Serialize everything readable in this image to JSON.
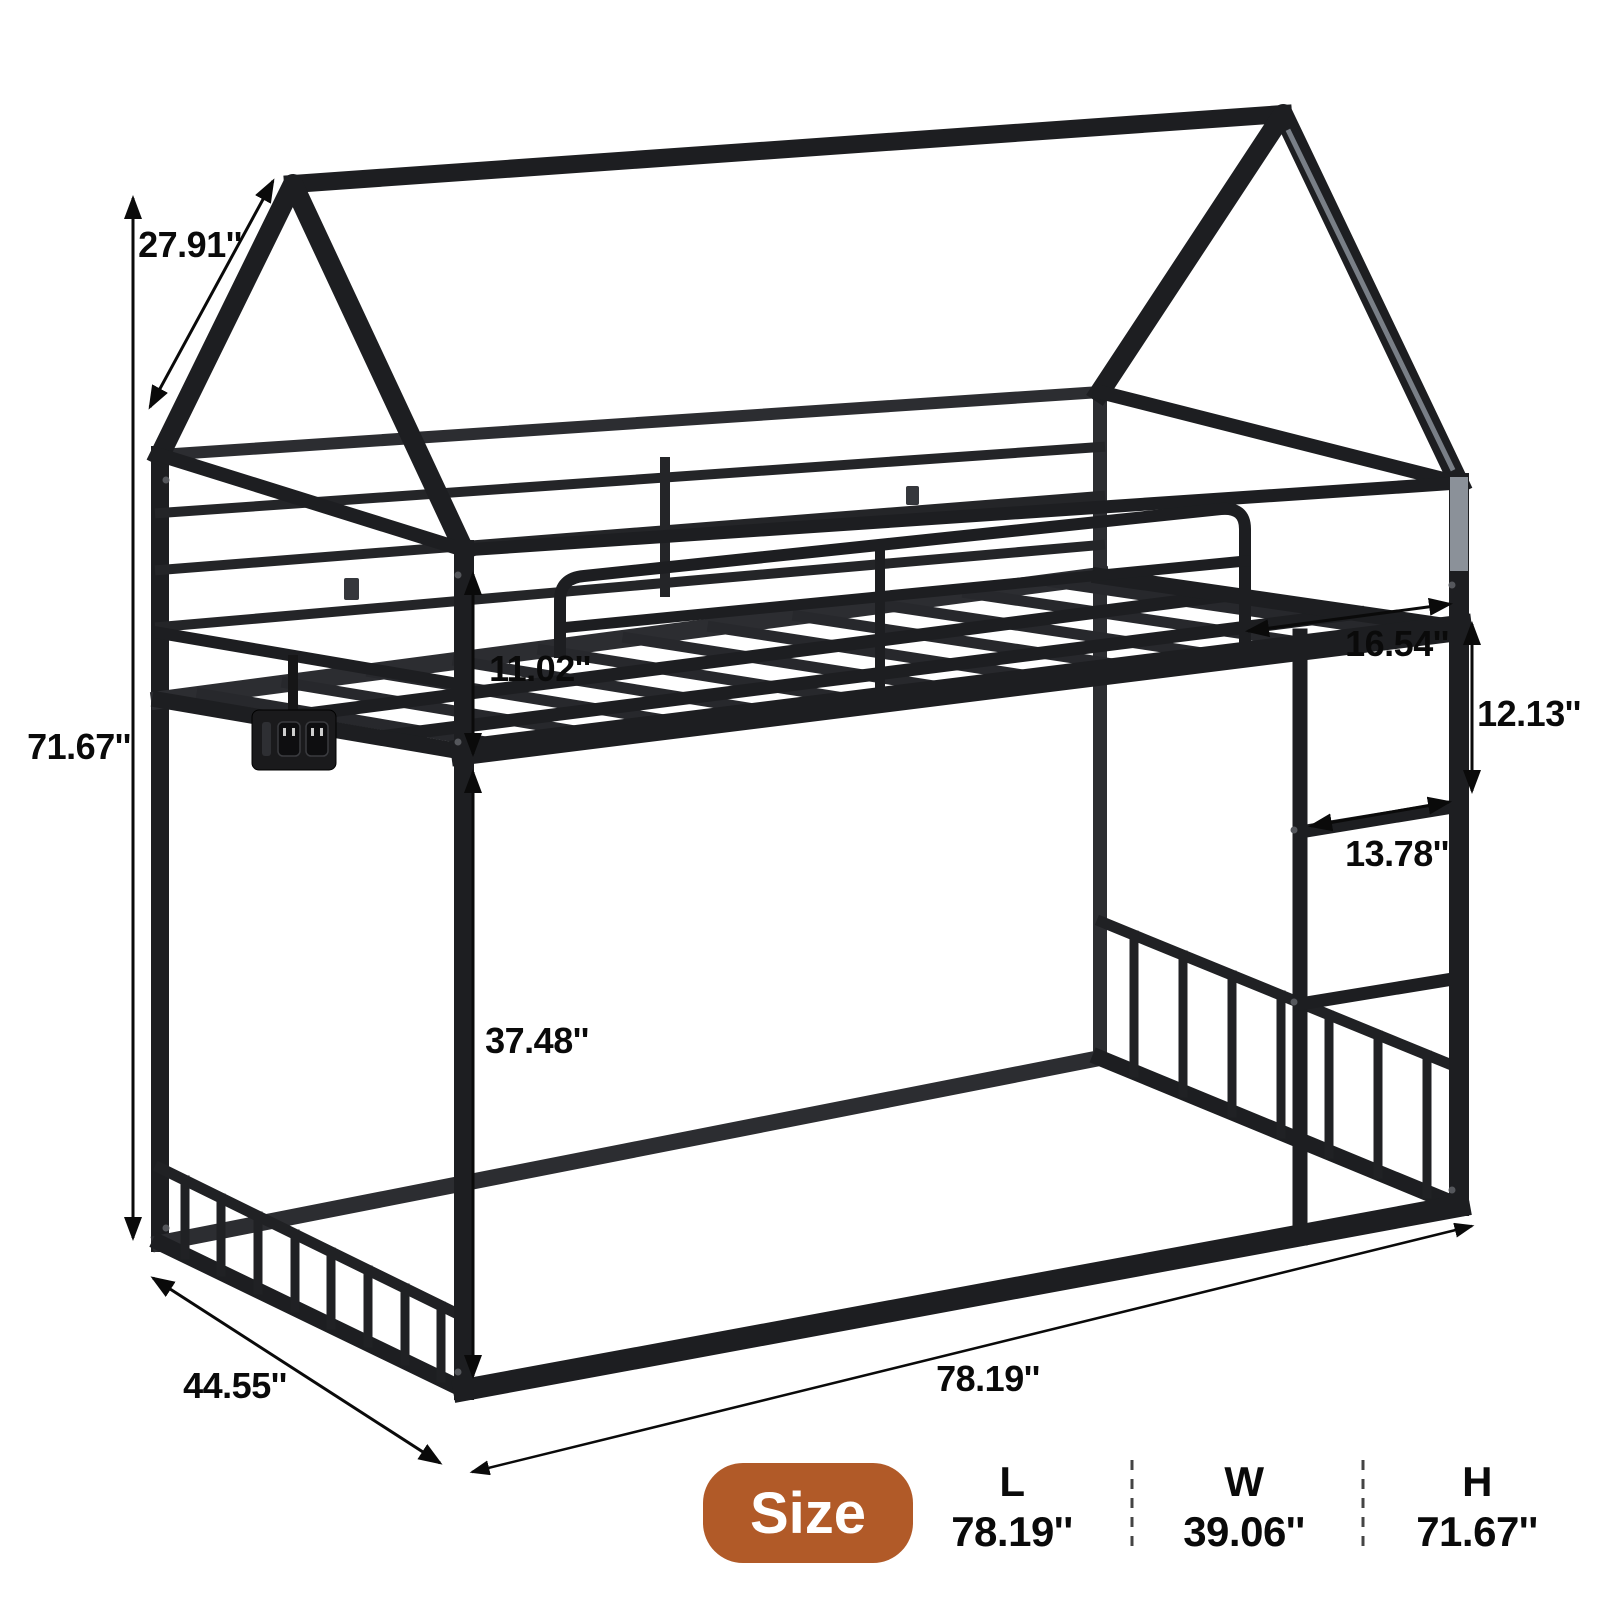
{
  "figure": {
    "description": "House-shaped metal bunk bed frame dimension diagram",
    "background": "#ffffff",
    "frame_color": "#1d1e21",
    "annotation_color": "#0a0a0a"
  },
  "annotations": {
    "roof_edge": "27.91''",
    "overall_height": "71.67''",
    "guardrail_to_slats": "11.02''",
    "under_bed_clearance": "37.48''",
    "ladder_opening_width": "16.54''",
    "rung_spacing": "12.13''",
    "rung_length": "13.78''",
    "base_depth": "44.55''",
    "base_length": "78.19''"
  },
  "size_panel": {
    "badge_label": "Size",
    "badge_color": "#b15a28",
    "columns": [
      {
        "label": "L",
        "value": "78.19''"
      },
      {
        "label": "W",
        "value": "39.06''"
      },
      {
        "label": "H",
        "value": "71.67''"
      }
    ]
  }
}
